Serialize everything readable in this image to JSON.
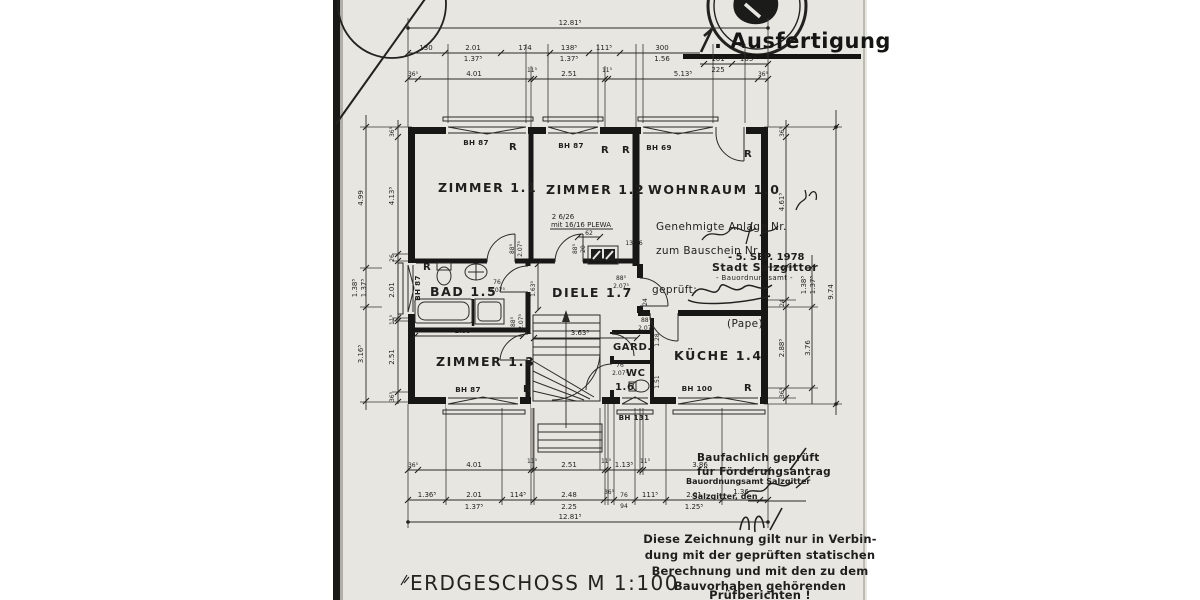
{
  "page": {
    "copy_number": "1",
    "copy_suffix": ". Ausfertigung",
    "title": "ERDGESCHOSS  M 1:100"
  },
  "rooms": {
    "z11": "ZIMMER 1.1",
    "z12": "ZIMMER 1.2",
    "wohnraum": "WOHNRAUM  1.0",
    "bad": "BAD 1.5",
    "diele": "DIELE 1.7",
    "z13": "ZIMMER 1.3",
    "gard": "GARD.",
    "wc": "WC",
    "wc_num": "1.6",
    "kueche": "KÜCHE  1.4"
  },
  "windows": {
    "bh87": "BH 87",
    "bh69": "BH 69",
    "bh100": "BH 100",
    "bh131": "BH 131",
    "shutter": "R"
  },
  "chimney": {
    "note1": "2 6/26",
    "note2": "mit 16/16 PLEWA",
    "width": "62",
    "flue": "13/26"
  },
  "stamps": {
    "approval": {
      "l1": "Genehmigte Anlage Nr.",
      "l2": "zum Bauschein Nr.",
      "date": "- 5. SEP. 1978",
      "city": "Stadt Salzgitter",
      "office": "- Bauordnungsamt -",
      "checked": "geprüft:",
      "signer": "(Pape)"
    },
    "funding": {
      "l1": "Baufachlich geprüft",
      "l2": "für Förderungsantrag",
      "office": "Bauordnungsamt Salzgitter",
      "place": "Salzgitter, den"
    }
  },
  "disclaimer": {
    "l1": "Diese Zeichnung gilt nur in Verbin-",
    "l2": "dung mit der geprüften statischen",
    "l3": "Berechnung und mit den zu dem",
    "l4": "Bauvorhaben gehörenden",
    "l5": "Prüfberichten !"
  },
  "dims": {
    "total": "12.81⁵",
    "t2": {
      "a": "130",
      "b1": "2.01",
      "b2": "1.37⁵",
      "c": "174",
      "d1": "138⁵",
      "d2": "1.37⁵",
      "e": "111⁵",
      "f1": "300",
      "f2": "1.56",
      "g1": "101",
      "g2": "225",
      "h": "105⁵"
    },
    "t3": {
      "a": "36⁵",
      "b": "4.01",
      "c": "11⁵",
      "d": "2.51",
      "e": "11⁵",
      "f": "5.13⁵",
      "g": "36⁵"
    },
    "ba": {
      "a": "36⁵",
      "b": "4.01",
      "c": "11⁵",
      "d": "2.51",
      "e": "11⁵",
      "f": "1.13⁵",
      "g": "11⁵",
      "h": "3.86"
    },
    "bb": {
      "a": "1.36⁵",
      "b1": "2.01",
      "b2": "1.37⁵",
      "c": "114⁵",
      "d1": "2.48",
      "d2": "2.25",
      "e": "36⁵",
      "f1": "76",
      "f2": "94",
      "g": "111⁵",
      "h1": "2.01",
      "h2": "1.25⁵",
      "i": "1.36"
    },
    "lo": {
      "a": "4.99",
      "b1": "1.38⁵",
      "b2": "1.37⁵",
      "c": "3.16⁵"
    },
    "li": {
      "a": "36⁵",
      "b": "4.13⁵",
      "c": "26",
      "d": "2.01",
      "e": "11⁵",
      "f": "2.51",
      "g": "36⁵"
    },
    "ri": {
      "a": "36⁵",
      "b": "4.61⁵",
      "c": "24",
      "d": "2.88⁵",
      "e": "36⁵"
    },
    "rm": {
      "a1": "1.38⁵",
      "a2": "1.37⁵",
      "b": "3.76"
    },
    "ro": {
      "a": "9.74"
    },
    "bad_w": "2.88⁵",
    "small11": "11",
    "diele_w": "3.63⁵",
    "diele_h": "1.63⁵",
    "doors": {
      "w88": "88⁵",
      "w76": "76",
      "h207": "2.07⁵",
      "h20": "20"
    },
    "gw": {
      "a": "1.28",
      "b": "1.51",
      "c": "24"
    }
  }
}
